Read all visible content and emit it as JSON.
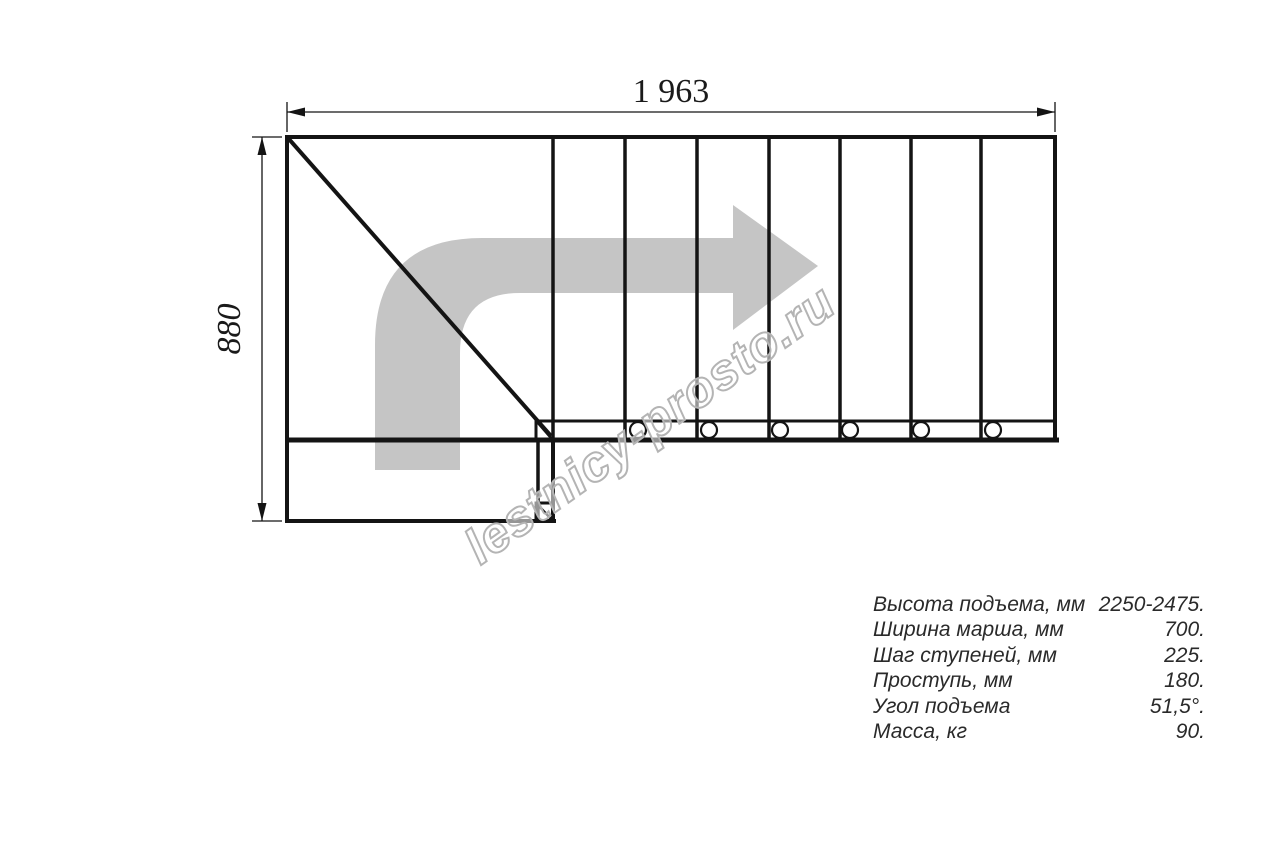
{
  "drawing": {
    "top_dimension": "1 963",
    "left_dimension": "880",
    "watermark": "lestnicy-prosto.ru",
    "colors": {
      "line": "#141414",
      "arrow_fill": "#c5c5c5",
      "watermark_stroke": "#b4b4b4"
    }
  },
  "specs": {
    "rows": [
      {
        "label": "Высота подъема, мм",
        "value": "2250-2475."
      },
      {
        "label": "Ширина марша, мм",
        "value": "700."
      },
      {
        "label": "Шаг ступеней, мм",
        "value": "225."
      },
      {
        "label": "Проступь, мм",
        "value": "180."
      },
      {
        "label": "Угол подъема",
        "value": "51,5°."
      },
      {
        "label": "Масса, кг",
        "value": "90."
      }
    ]
  }
}
